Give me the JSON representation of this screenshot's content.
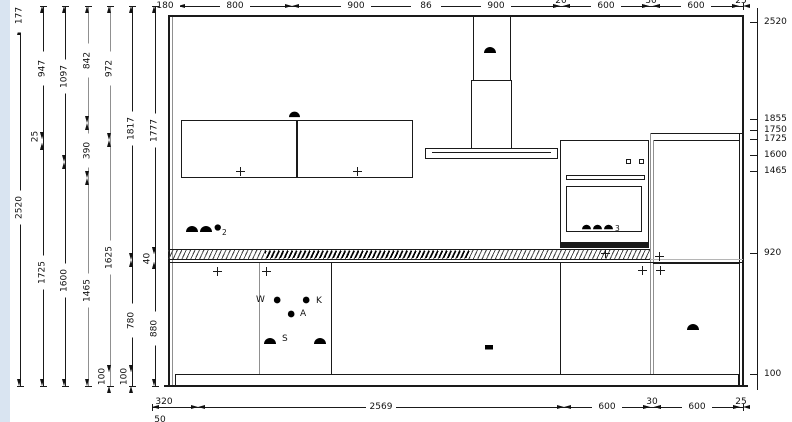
{
  "drawing": {
    "colors": {
      "line": "#1a1a1a",
      "muted": "#909090",
      "margin_strip": "#d9e4f1",
      "background": "#ffffff"
    },
    "top_dimension_row": {
      "y": 6,
      "ticks": [
        152,
        178,
        292,
        420,
        432,
        560,
        563,
        649,
        653,
        739,
        743
      ],
      "labels": [
        {
          "text": "180",
          "x": 165,
          "pos": "on"
        },
        {
          "text": "800",
          "x": 235,
          "pos": "on"
        },
        {
          "text": "900",
          "x": 356,
          "pos": "on"
        },
        {
          "text": "86",
          "x": 426,
          "pos": "on"
        },
        {
          "text": "900",
          "x": 496,
          "pos": "on"
        },
        {
          "text": "20",
          "x": 561,
          "pos": "above"
        },
        {
          "text": "600",
          "x": 606,
          "pos": "on"
        },
        {
          "text": "30",
          "x": 651,
          "pos": "above"
        },
        {
          "text": "600",
          "x": 696,
          "pos": "on"
        },
        {
          "text": "25",
          "x": 741,
          "pos": "above"
        }
      ]
    },
    "bottom_dimension_row": {
      "y": 407,
      "ticks": [
        152,
        198,
        564,
        650,
        654,
        740,
        743
      ],
      "labels": [
        {
          "text": "320",
          "x": 164,
          "pos": "above"
        },
        {
          "text": "2569",
          "x": 381,
          "pos": "on"
        },
        {
          "text": "600",
          "x": 607,
          "pos": "on"
        },
        {
          "text": "30",
          "x": 652,
          "pos": "above"
        },
        {
          "text": "600",
          "x": 697,
          "pos": "on"
        },
        {
          "text": "25",
          "x": 741,
          "pos": "above"
        }
      ],
      "cutoff_label": {
        "text": "50",
        "x": 160,
        "y": 415
      }
    },
    "left_dimension_columns": [
      {
        "x": 20,
        "ticks": [
          3,
          28,
          386
        ],
        "color": "dark",
        "labels": [
          {
            "text": "177",
            "y": 15,
            "pos": "on"
          },
          {
            "text": "2520",
            "y": 207,
            "pos": "on"
          }
        ]
      },
      {
        "x": 43,
        "ticks": [
          6,
          139,
          143,
          386
        ],
        "color": "dark",
        "labels": [
          {
            "text": "947",
            "y": 68,
            "pos": "on"
          },
          {
            "text": "25",
            "y": 136,
            "pos": "side"
          },
          {
            "text": "1725",
            "y": 272,
            "pos": "on"
          }
        ]
      },
      {
        "x": 65,
        "ticks": [
          6,
          162,
          386
        ],
        "color": "dark",
        "labels": [
          {
            "text": "1097",
            "y": 76,
            "pos": "on"
          },
          {
            "text": "1600",
            "y": 280,
            "pos": "on"
          }
        ]
      },
      {
        "x": 88,
        "ticks": [
          6,
          123,
          178,
          386
        ],
        "color": "gray",
        "labels": [
          {
            "text": "842",
            "y": 60,
            "pos": "on"
          },
          {
            "text": "390",
            "y": 150,
            "pos": "on"
          },
          {
            "text": "1465",
            "y": 290,
            "pos": "on"
          }
        ]
      },
      {
        "x": 110,
        "ticks": [
          6,
          140,
          372,
          386
        ],
        "color": "gray",
        "labels": [
          {
            "text": "972",
            "y": 68,
            "pos": "on"
          },
          {
            "text": "1625",
            "y": 257,
            "pos": "on"
          },
          {
            "text": "100",
            "y": 376,
            "pos": "side"
          }
        ]
      },
      {
        "x": 132,
        "ticks": [
          6,
          260,
          372,
          386
        ],
        "color": "dark",
        "labels": [
          {
            "text": "1817",
            "y": 128,
            "pos": "on"
          },
          {
            "text": "780",
            "y": 320,
            "pos": "on"
          },
          {
            "text": "100",
            "y": 376,
            "pos": "side"
          }
        ]
      },
      {
        "x": 155,
        "ticks": [
          6,
          254,
          262,
          386
        ],
        "color": "dark",
        "labels": [
          {
            "text": "1777",
            "y": 130,
            "pos": "on"
          },
          {
            "text": "40",
            "y": 258,
            "pos": "side"
          },
          {
            "text": "880",
            "y": 328,
            "pos": "on"
          }
        ]
      }
    ],
    "right_height_scale": {
      "x": 757,
      "y_top": 8,
      "y_bottom": 390,
      "entries": [
        {
          "text": "2697",
          "y": -2
        },
        {
          "text": "2520",
          "y": 22
        },
        {
          "text": "1855",
          "y": 119
        },
        {
          "text": "1750",
          "y": 130
        },
        {
          "text": "1725",
          "y": 139
        },
        {
          "text": "1600",
          "y": 155
        },
        {
          "text": "1465",
          "y": 171
        },
        {
          "text": "920",
          "y": 253
        },
        {
          "text": "100",
          "y": 374
        }
      ]
    },
    "connection_labels": {
      "w": "W",
      "k": "K",
      "a": "A",
      "s": "S",
      "socket_count": "2",
      "cooker_circuits": "3"
    },
    "cross_markers": [
      [
        240,
        171
      ],
      [
        357,
        171
      ],
      [
        217,
        271
      ],
      [
        266,
        271
      ],
      [
        605,
        253
      ],
      [
        659,
        256
      ],
      [
        642,
        270
      ],
      [
        660,
        270
      ]
    ],
    "symbols": [
      {
        "type": "power-connection",
        "x": 483,
        "y": 42,
        "s": 14
      },
      {
        "type": "power-connection",
        "x": 288,
        "y": 107,
        "s": 13
      },
      {
        "type": "power-connection",
        "x": 185,
        "y": 221,
        "s": 14
      },
      {
        "type": "power-connection",
        "x": 199,
        "y": 221,
        "s": 14
      },
      {
        "type": "circle-slash",
        "x": 213,
        "y": 223,
        "s": 11
      },
      {
        "type": "power-connection",
        "x": 263,
        "y": 333,
        "s": 14
      },
      {
        "type": "power-connection",
        "x": 313,
        "y": 333,
        "s": 14
      },
      {
        "type": "power-connection",
        "x": 686,
        "y": 319,
        "s": 14
      },
      {
        "type": "power-connection",
        "x": 581,
        "y": 221,
        "s": 11
      },
      {
        "type": "power-connection",
        "x": 592,
        "y": 221,
        "s": 11
      },
      {
        "type": "power-connection",
        "x": 603,
        "y": 221,
        "s": 11
      },
      {
        "type": "circle-cross",
        "x": 272,
        "y": 295,
        "s": 12
      },
      {
        "type": "circle-cross",
        "x": 301,
        "y": 295,
        "s": 12
      },
      {
        "type": "circle-cross",
        "x": 286,
        "y": 309,
        "s": 12
      },
      {
        "type": "socket",
        "x": 482,
        "y": 339,
        "s": 14
      }
    ]
  }
}
